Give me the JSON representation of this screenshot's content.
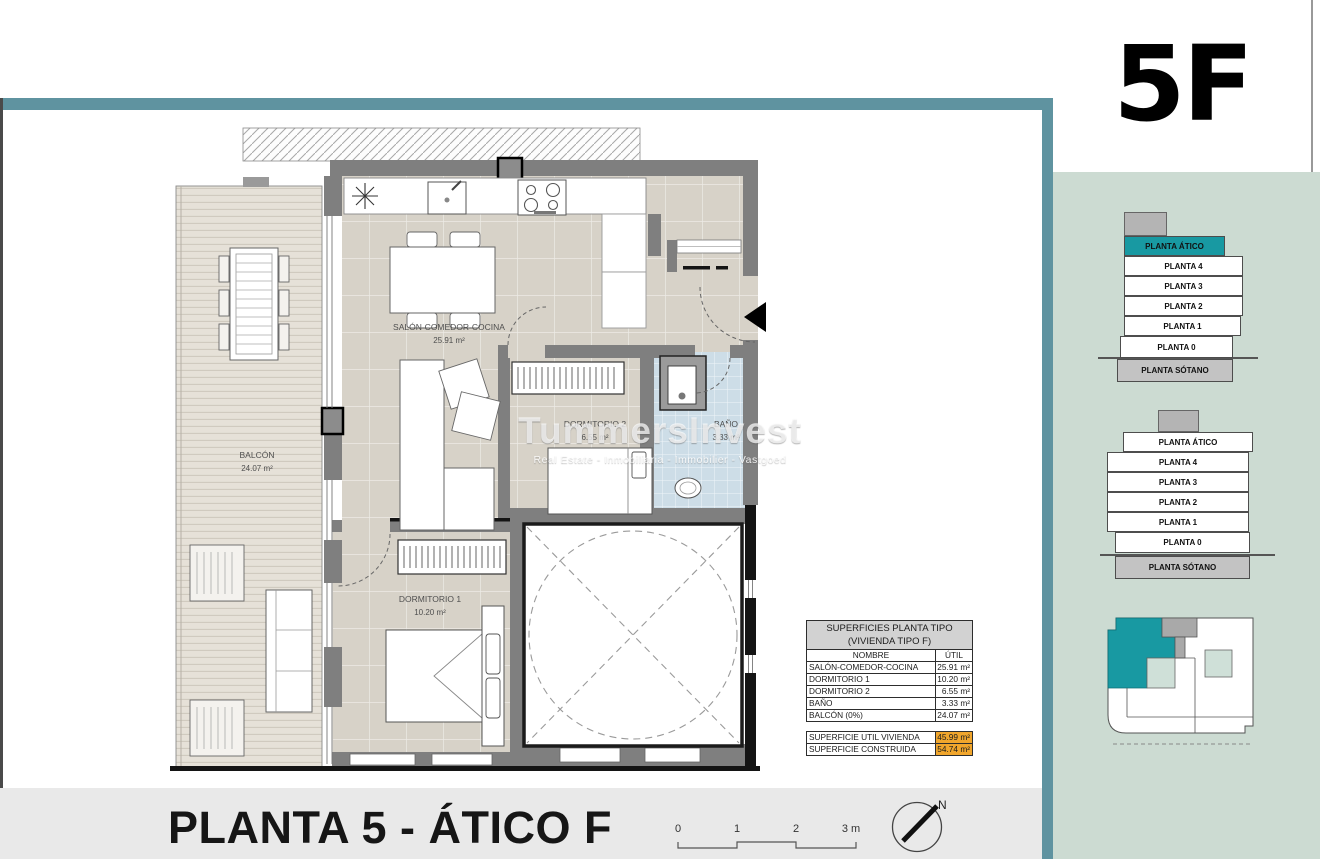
{
  "unit": {
    "code": "5F"
  },
  "plan": {
    "title": "PLANTA 5 - ÁTICO F",
    "rooms": {
      "salon": {
        "name": "SALÓN-COMEDOR-COCINA",
        "area": "25.91 m²"
      },
      "balcon": {
        "name": "BALCÓN",
        "area": "24.07 m²"
      },
      "dorm1": {
        "name": "DORMITORIO 1",
        "area": "10.20 m²"
      },
      "dorm2": {
        "name": "DORMITORIO 2",
        "area": "6.55 m²"
      },
      "bano": {
        "name": "BAÑO",
        "area": "3.33 m²"
      }
    },
    "scale": {
      "t0": "0",
      "t1": "1",
      "t2": "2",
      "t3": "3 m"
    },
    "north_label": "N"
  },
  "watermark": {
    "brand": "TummersInvest",
    "tagline": "Real Estate - Inmobiliaria - Immobilier - Vastgoed"
  },
  "table": {
    "title1": "SUPERFICIES PLANTA TIPO",
    "title2": "(VIVIENDA TIPO F)",
    "col_nombre": "NOMBRE",
    "col_util": "ÚTIL",
    "rows": [
      {
        "name": "SALÓN-COMEDOR-COCINA",
        "util": "25.91 m²"
      },
      {
        "name": "DORMITORIO 1",
        "util": "10.20 m²"
      },
      {
        "name": "DORMITORIO 2",
        "util": "6.55 m²"
      },
      {
        "name": "BAÑO",
        "util": "3.33 m²"
      },
      {
        "name": "BALCÓN (0%)",
        "util": "24.07 m²"
      }
    ],
    "totals": [
      {
        "name": "SUPERFICIE UTIL VIVIENDA",
        "value": "45.99 m²"
      },
      {
        "name": "SUPERFICIE CONSTRUIDA",
        "value": "54.74 m²"
      }
    ]
  },
  "sidebar": {
    "stack1": {
      "levels": [
        "PLANTA ÁTICO",
        "PLANTA 4",
        "PLANTA 3",
        "PLANTA 2",
        "PLANTA 1",
        "PLANTA 0",
        "PLANTA SÓTANO"
      ],
      "highlighted": "PLANTA ÁTICO"
    },
    "stack2": {
      "levels": [
        "PLANTA ÁTICO",
        "PLANTA 4",
        "PLANTA 3",
        "PLANTA 2",
        "PLANTA 1",
        "PLANTA 0",
        "PLANTA SÓTANO"
      ]
    }
  },
  "colors": {
    "accent_teal": "#5f93a0",
    "highlight_teal": "#1899a2",
    "sidebar_green": "#ccdbd2",
    "totals_orange": "#f1a62c"
  }
}
